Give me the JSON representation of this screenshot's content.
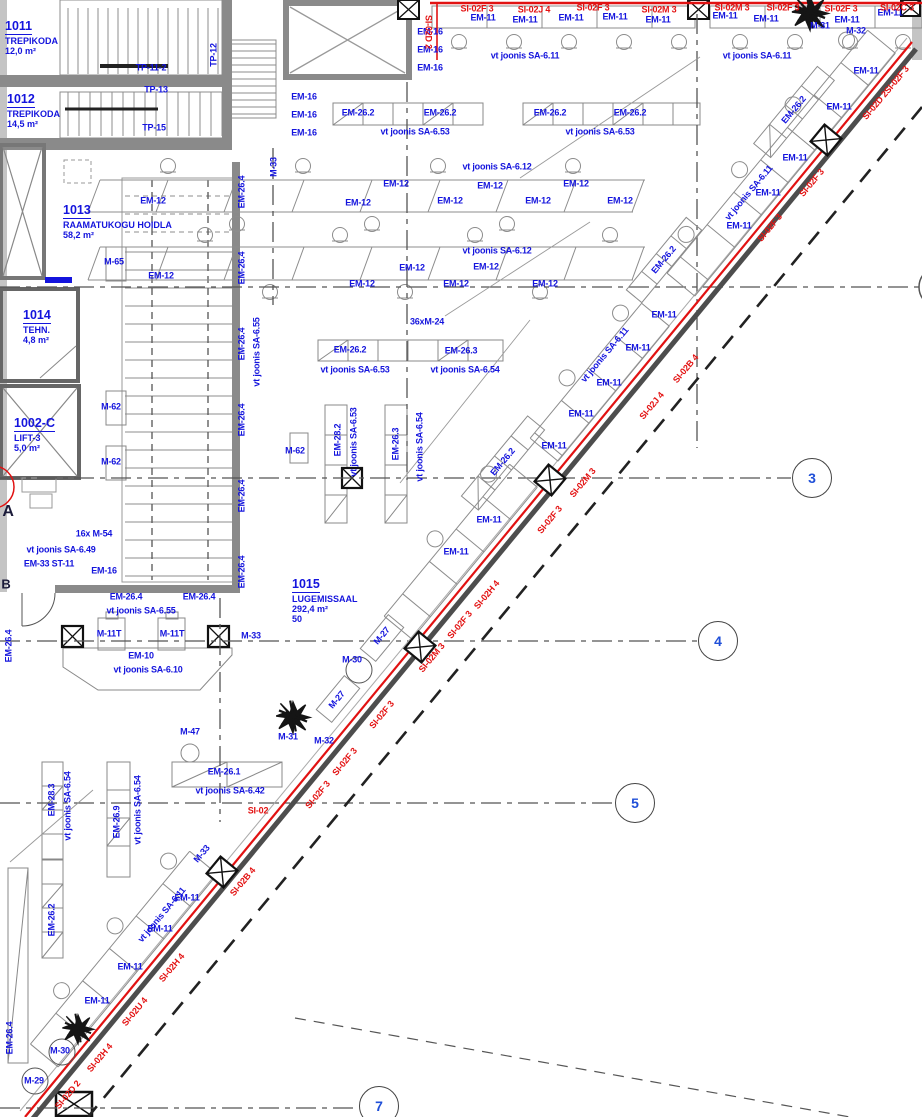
{
  "rooms": [
    {
      "number": "1011",
      "name": "TREPIKODA",
      "area": "12,0 m²",
      "extra": "",
      "x": 5,
      "y": 16
    },
    {
      "number": "1012",
      "name": "TREPIKODA",
      "area": "14,5 m²",
      "extra": "",
      "x": 7,
      "y": 89
    },
    {
      "number": "1013",
      "name": "RAAMATUKOGU HOIDLA",
      "area": "58,2 m²",
      "extra": "",
      "x": 63,
      "y": 200
    },
    {
      "number": "1014",
      "name": "TEHN.",
      "area": "4,8 m²",
      "extra": "",
      "x": 23,
      "y": 305
    },
    {
      "number": "1002-C",
      "name": "LIFT-3",
      "area": "5,0 m²",
      "extra": "",
      "x": 14,
      "y": 413
    },
    {
      "number": "1015",
      "name": "LUGEMISSAAL",
      "area": "292,4 m²",
      "extra": "50",
      "x": 292,
      "y": 574
    }
  ],
  "grid": {
    "bubbles": [
      {
        "label": "3",
        "x": 812,
        "y": 478
      },
      {
        "label": "4",
        "x": 718,
        "y": 641
      },
      {
        "label": "5",
        "x": 635,
        "y": 803
      },
      {
        "label": "7",
        "x": 379,
        "y": 1106
      }
    ]
  },
  "labels": [
    {
      "t": "TP-11-2",
      "x": 151,
      "y": 68
    },
    {
      "t": "TP-13",
      "x": 156,
      "y": 90
    },
    {
      "t": "TP-15",
      "x": 154,
      "y": 128
    },
    {
      "t": "TP-12",
      "x": 214,
      "y": 55,
      "r": -90
    },
    {
      "t": "M-33",
      "x": 274,
      "y": 167,
      "r": -90
    },
    {
      "t": "EM-16",
      "x": 430,
      "y": 32
    },
    {
      "t": "EM-16",
      "x": 430,
      "y": 50
    },
    {
      "t": "EM-16",
      "x": 430,
      "y": 68
    },
    {
      "t": "EM-16",
      "x": 304,
      "y": 97
    },
    {
      "t": "EM-16",
      "x": 304,
      "y": 115
    },
    {
      "t": "EM-16",
      "x": 304,
      "y": 133
    },
    {
      "t": "EM-11",
      "x": 483,
      "y": 18
    },
    {
      "t": "EM-11",
      "x": 525,
      "y": 20
    },
    {
      "t": "EM-11",
      "x": 571,
      "y": 18
    },
    {
      "t": "EM-11",
      "x": 615,
      "y": 17
    },
    {
      "t": "EM-11",
      "x": 658,
      "y": 20
    },
    {
      "t": "EM-11",
      "x": 725,
      "y": 16
    },
    {
      "t": "EM-11",
      "x": 766,
      "y": 19
    },
    {
      "t": "EM-11",
      "x": 847,
      "y": 20
    },
    {
      "t": "EM-11",
      "x": 890,
      "y": 13
    },
    {
      "t": "vt joonis SA-6.11",
      "x": 525,
      "y": 56
    },
    {
      "t": "vt joonis SA-6.11",
      "x": 757,
      "y": 56
    },
    {
      "t": "M-31",
      "x": 820,
      "y": 26
    },
    {
      "t": "M-32",
      "x": 856,
      "y": 31
    },
    {
      "t": "SI-02F 3",
      "x": 477,
      "y": 9,
      "c": "r"
    },
    {
      "t": "SI-02J 4",
      "x": 534,
      "y": 10,
      "c": "r"
    },
    {
      "t": "SI-02F 3",
      "x": 593,
      "y": 8,
      "c": "r"
    },
    {
      "t": "SI-02M 3",
      "x": 659,
      "y": 10,
      "c": "r"
    },
    {
      "t": "SI-02M 3",
      "x": 732,
      "y": 8,
      "c": "r"
    },
    {
      "t": "SI-02F 3",
      "x": 783,
      "y": 8,
      "c": "r"
    },
    {
      "t": "SI-02F 3",
      "x": 841,
      "y": 9,
      "c": "r"
    },
    {
      "t": "SI-02C 3",
      "x": 897,
      "y": 8,
      "c": "r"
    },
    {
      "t": "SI-02D 2",
      "x": 428,
      "y": 32,
      "r": 90,
      "c": "r"
    },
    {
      "t": "EM-26.2",
      "x": 358,
      "y": 113
    },
    {
      "t": "EM-26.2",
      "x": 440,
      "y": 113
    },
    {
      "t": "EM-26.2",
      "x": 550,
      "y": 113
    },
    {
      "t": "EM-26.2",
      "x": 630,
      "y": 113
    },
    {
      "t": "vt joonis SA-6.53",
      "x": 415,
      "y": 132
    },
    {
      "t": "vt joonis SA-6.53",
      "x": 600,
      "y": 132
    },
    {
      "t": "vt joonis SA-6.12",
      "x": 497,
      "y": 167
    },
    {
      "t": "EM-12",
      "x": 153,
      "y": 201
    },
    {
      "t": "EM-12",
      "x": 358,
      "y": 203
    },
    {
      "t": "EM-12",
      "x": 396,
      "y": 184
    },
    {
      "t": "EM-12",
      "x": 450,
      "y": 201
    },
    {
      "t": "EM-12",
      "x": 490,
      "y": 186
    },
    {
      "t": "EM-12",
      "x": 538,
      "y": 201
    },
    {
      "t": "EM-12",
      "x": 576,
      "y": 184
    },
    {
      "t": "EM-12",
      "x": 620,
      "y": 201
    },
    {
      "t": "vt joonis SA-6.12",
      "x": 497,
      "y": 251
    },
    {
      "t": "EM-12",
      "x": 161,
      "y": 276
    },
    {
      "t": "EM-12",
      "x": 362,
      "y": 284
    },
    {
      "t": "EM-12",
      "x": 412,
      "y": 268
    },
    {
      "t": "EM-12",
      "x": 456,
      "y": 284
    },
    {
      "t": "EM-12",
      "x": 486,
      "y": 267
    },
    {
      "t": "EM-12",
      "x": 545,
      "y": 284
    },
    {
      "t": "36xM-24",
      "x": 427,
      "y": 322
    },
    {
      "t": "EM-26.2",
      "x": 350,
      "y": 350
    },
    {
      "t": "EM-26.3",
      "x": 461,
      "y": 351
    },
    {
      "t": "vt joonis SA-6.53",
      "x": 355,
      "y": 370
    },
    {
      "t": "vt joonis SA-6.54",
      "x": 465,
      "y": 370
    },
    {
      "t": "EM-28.2",
      "x": 338,
      "y": 440,
      "r": -90
    },
    {
      "t": "vt joonis SA-6.53",
      "x": 354,
      "y": 442,
      "r": -90
    },
    {
      "t": "EM-26.3",
      "x": 396,
      "y": 444,
      "r": -90
    },
    {
      "t": "vt joonis SA-6.54",
      "x": 420,
      "y": 447,
      "r": -90
    },
    {
      "t": "EM-26.4",
      "x": 242,
      "y": 192,
      "r": -90
    },
    {
      "t": "EM-26.4",
      "x": 242,
      "y": 268,
      "r": -90
    },
    {
      "t": "EM-26.4",
      "x": 242,
      "y": 344,
      "r": -90
    },
    {
      "t": "EM-26.4",
      "x": 242,
      "y": 420,
      "r": -90
    },
    {
      "t": "EM-26.4",
      "x": 242,
      "y": 496,
      "r": -90
    },
    {
      "t": "EM-26.4",
      "x": 242,
      "y": 572,
      "r": -90
    },
    {
      "t": "vt joonis SA-6.55",
      "x": 257,
      "y": 352,
      "r": -90
    },
    {
      "t": "M-65",
      "x": 114,
      "y": 262
    },
    {
      "t": "M-62",
      "x": 111,
      "y": 407
    },
    {
      "t": "M-62",
      "x": 111,
      "y": 462
    },
    {
      "t": "M-62",
      "x": 295,
      "y": 451
    },
    {
      "t": "16x M-54",
      "x": 94,
      "y": 534
    },
    {
      "t": "vt joonis SA-6.49",
      "x": 61,
      "y": 550
    },
    {
      "t": "EM-33 ST-11",
      "x": 49,
      "y": 564
    },
    {
      "t": "EM-16",
      "x": 104,
      "y": 571
    },
    {
      "t": "EM-26.4",
      "x": 126,
      "y": 597
    },
    {
      "t": "EM-26.4",
      "x": 199,
      "y": 597
    },
    {
      "t": "vt joonis SA-6.55",
      "x": 141,
      "y": 611
    },
    {
      "t": "M-11T",
      "x": 109,
      "y": 634
    },
    {
      "t": "M-11T",
      "x": 172,
      "y": 634
    },
    {
      "t": "M-33",
      "x": 251,
      "y": 636
    },
    {
      "t": "EM-10",
      "x": 141,
      "y": 656
    },
    {
      "t": "vt joonis SA-6.10",
      "x": 148,
      "y": 670
    },
    {
      "t": "EM-26.4",
      "x": 9,
      "y": 646,
      "r": -90
    },
    {
      "t": "M-47",
      "x": 190,
      "y": 732
    },
    {
      "t": "EM-26.1",
      "x": 224,
      "y": 772
    },
    {
      "t": "vt joonis SA-6.42",
      "x": 230,
      "y": 791
    },
    {
      "t": "SI-02",
      "x": 258,
      "y": 811,
      "c": "r"
    },
    {
      "t": "M-31",
      "x": 288,
      "y": 737
    },
    {
      "t": "M-32",
      "x": 324,
      "y": 741
    },
    {
      "t": "M-27",
      "x": 382,
      "y": 636,
      "r": -50
    },
    {
      "t": "M-27",
      "x": 337,
      "y": 700,
      "r": -50
    },
    {
      "t": "M-30",
      "x": 352,
      "y": 660
    },
    {
      "t": "EM-28.3",
      "x": 52,
      "y": 800,
      "r": -90
    },
    {
      "t": "vt joonis SA-6.54",
      "x": 68,
      "y": 806,
      "r": -90
    },
    {
      "t": "EM-26.2",
      "x": 52,
      "y": 920,
      "r": -90
    },
    {
      "t": "EM-26.9",
      "x": 117,
      "y": 822,
      "r": -90
    },
    {
      "t": "vt joonis SA-6.54",
      "x": 138,
      "y": 810,
      "r": -90
    },
    {
      "t": "EM-11",
      "x": 866,
      "y": 71
    },
    {
      "t": "EM-11",
      "x": 839,
      "y": 107
    },
    {
      "t": "EM-11",
      "x": 795,
      "y": 158
    },
    {
      "t": "EM-11",
      "x": 768,
      "y": 193
    },
    {
      "t": "EM-11",
      "x": 739,
      "y": 226
    },
    {
      "t": "EM-26.2",
      "x": 794,
      "y": 110,
      "r": -50
    },
    {
      "t": "vt joonis SA-6.11",
      "x": 749,
      "y": 193,
      "r": -50
    },
    {
      "t": "EM-26.2",
      "x": 664,
      "y": 260,
      "r": -50
    },
    {
      "t": "EM-11",
      "x": 664,
      "y": 315
    },
    {
      "t": "EM-11",
      "x": 638,
      "y": 348
    },
    {
      "t": "EM-11",
      "x": 609,
      "y": 383
    },
    {
      "t": "EM-11",
      "x": 581,
      "y": 414
    },
    {
      "t": "EM-11",
      "x": 554,
      "y": 446
    },
    {
      "t": "vt joonis SA-6.11",
      "x": 605,
      "y": 355,
      "r": -50
    },
    {
      "t": "EM-26.2",
      "x": 503,
      "y": 462,
      "r": -50
    },
    {
      "t": "EM-11",
      "x": 489,
      "y": 520
    },
    {
      "t": "EM-11",
      "x": 456,
      "y": 552
    },
    {
      "t": "M-33",
      "x": 202,
      "y": 854,
      "r": -50
    },
    {
      "t": "EM-11",
      "x": 187,
      "y": 898
    },
    {
      "t": "EM-11",
      "x": 160,
      "y": 929
    },
    {
      "t": "EM-11",
      "x": 130,
      "y": 967
    },
    {
      "t": "EM-11",
      "x": 97,
      "y": 1001
    },
    {
      "t": "vt joonis SA-6.11",
      "x": 162,
      "y": 915,
      "r": -50
    },
    {
      "t": "M-30",
      "x": 60,
      "y": 1051
    },
    {
      "t": "M-29",
      "x": 34,
      "y": 1081
    },
    {
      "t": "EM-26.4",
      "x": 10,
      "y": 1038,
      "r": -90
    },
    {
      "t": "SI-02D 2SI-02F 3",
      "x": 886,
      "y": 93,
      "r": -50,
      "c": "r"
    },
    {
      "t": "SI-02F 3",
      "x": 812,
      "y": 183,
      "r": -50,
      "c": "r"
    },
    {
      "t": "SI-02F 3",
      "x": 770,
      "y": 228,
      "r": -50,
      "c": "r"
    },
    {
      "t": "SI-02B 4",
      "x": 686,
      "y": 369,
      "r": -50,
      "c": "r"
    },
    {
      "t": "SI-02J 4",
      "x": 652,
      "y": 406,
      "r": -50,
      "c": "r"
    },
    {
      "t": "SI-02M 3",
      "x": 583,
      "y": 483,
      "r": -50,
      "c": "r"
    },
    {
      "t": "SI-02F 3",
      "x": 550,
      "y": 520,
      "r": -50,
      "c": "r"
    },
    {
      "t": "SI-02H 4",
      "x": 487,
      "y": 595,
      "r": -50,
      "c": "r"
    },
    {
      "t": "SI-02F 3",
      "x": 460,
      "y": 625,
      "r": -50,
      "c": "r"
    },
    {
      "t": "SI-02M 3",
      "x": 432,
      "y": 658,
      "r": -50,
      "c": "r"
    },
    {
      "t": "SI-02F 3",
      "x": 382,
      "y": 715,
      "r": -50,
      "c": "r"
    },
    {
      "t": "SI-02F 3",
      "x": 345,
      "y": 762,
      "r": -50,
      "c": "r"
    },
    {
      "t": "SI-02F 3",
      "x": 318,
      "y": 795,
      "r": -50,
      "c": "r"
    },
    {
      "t": "SI-02B 4",
      "x": 243,
      "y": 882,
      "r": -50,
      "c": "r"
    },
    {
      "t": "SI-02H 4",
      "x": 172,
      "y": 968,
      "r": -50,
      "c": "r"
    },
    {
      "t": "SI-02U 4",
      "x": 135,
      "y": 1012,
      "r": -50,
      "c": "r"
    },
    {
      "t": "SI-02H 4",
      "x": 100,
      "y": 1058,
      "r": -50,
      "c": "r"
    },
    {
      "t": "SI-02D 2",
      "x": 68,
      "y": 1095,
      "r": -50,
      "c": "r"
    },
    {
      "t": "A",
      "x": 8,
      "y": 512,
      "c": "d",
      "s": 16,
      "n": "grid-letter"
    },
    {
      "t": "B",
      "x": 6,
      "y": 584,
      "c": "d",
      "s": 13,
      "n": "grid-letter"
    }
  ]
}
